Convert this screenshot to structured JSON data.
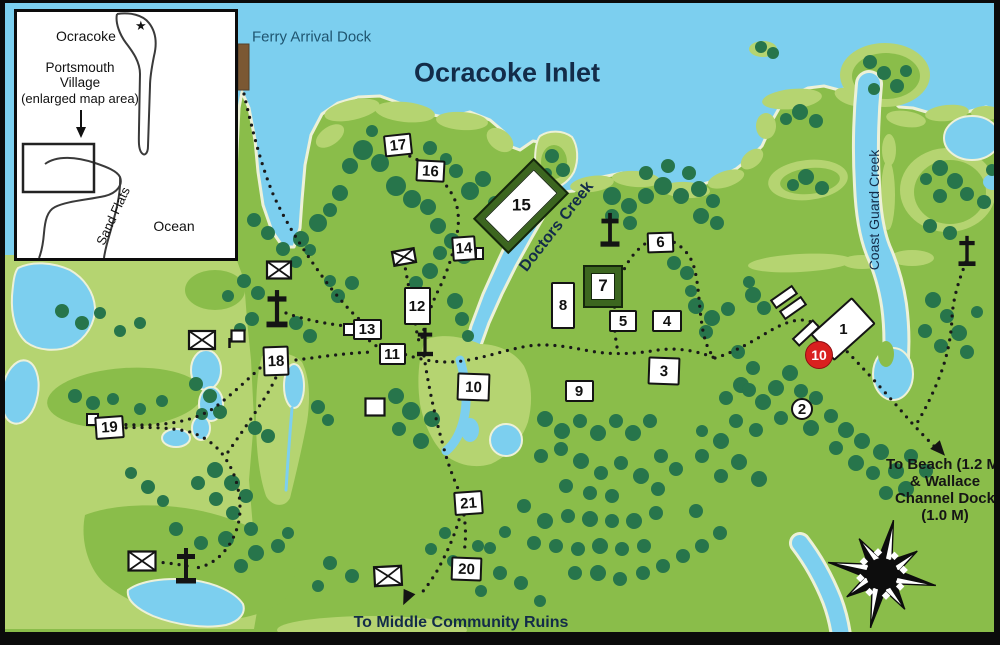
{
  "colors": {
    "water": "#7ccfef",
    "land": "#8abd4a",
    "land_light": "#b5d471",
    "trees": "#27754b",
    "shore": "#edf1d8",
    "trail": "#191919",
    "marker_red": "#d9201f",
    "navy": "#132c49",
    "ferry_label": "#1f5570",
    "dock_brown": "#7b5833"
  },
  "labels": [
    {
      "id": "ferry-arrival-dock",
      "text": "Ferry Arrival Dock",
      "x": 247,
      "y": 34,
      "size": 15,
      "color": "#1f5570",
      "rot": 0,
      "anchor": "left",
      "weight": "normal"
    },
    {
      "id": "ocracoke-inlet",
      "text": "Ocracoke Inlet",
      "x": 502,
      "y": 70,
      "size": 27,
      "color": "#132c49",
      "rot": 0,
      "anchor": "center",
      "weight": "600"
    },
    {
      "id": "doctors-creek",
      "text": "Doctors Creek",
      "x": 552,
      "y": 224,
      "size": 16,
      "color": "#132c49",
      "rot": -52,
      "anchor": "center",
      "weight": "bold"
    },
    {
      "id": "coast-guard-creek",
      "text": "Coast Guard Creek",
      "x": 869,
      "y": 207,
      "size": 14,
      "color": "#132c49",
      "rot": -90,
      "anchor": "center",
      "weight": "normal"
    },
    {
      "id": "to-middle-community-ruins",
      "text": "To Middle Community Ruins",
      "x": 456,
      "y": 620,
      "size": 16,
      "color": "#132c49",
      "rot": 0,
      "anchor": "center",
      "weight": "bold"
    },
    {
      "id": "to-beach-wallace-dock",
      "lines": [
        "To Beach (1.2 M)",
        "& Wallace",
        "Channel Dock",
        "(1.0 M)"
      ],
      "x": 940,
      "y": 487,
      "size": 15,
      "color": "#151515",
      "rot": 0,
      "anchor": "center",
      "weight": "bold"
    }
  ],
  "inset": {
    "region": "Ocracoke",
    "star": "★",
    "village_line1": "Portsmouth",
    "village_line2": "Village",
    "village_line3": "(enlarged map area)",
    "sand_flats": "Sand Flats",
    "ocean": "Ocean"
  },
  "markers": [
    {
      "num": "1",
      "x": 838,
      "y": 326,
      "w": 56,
      "h": 36,
      "rot": -42,
      "type": "building"
    },
    {
      "num": "2",
      "x": 797,
      "y": 406,
      "r": 11,
      "type": "circle"
    },
    {
      "num": "3",
      "x": 659,
      "y": 368,
      "w": 32,
      "h": 28,
      "rot": 2,
      "type": "box"
    },
    {
      "num": "4",
      "x": 662,
      "y": 318,
      "w": 30,
      "h": 22,
      "rot": 0,
      "type": "box"
    },
    {
      "num": "5",
      "x": 618,
      "y": 318,
      "w": 28,
      "h": 22,
      "rot": 0,
      "type": "box"
    },
    {
      "num": "6",
      "x": 655,
      "y": 239,
      "w": 27,
      "h": 21,
      "rot": -2,
      "type": "box"
    },
    {
      "num": "7",
      "x": 598,
      "y": 283,
      "w": 40,
      "h": 43,
      "rot": 0,
      "type": "box-green"
    },
    {
      "num": "8",
      "x": 558,
      "y": 302,
      "w": 24,
      "h": 47,
      "rot": 0,
      "type": "box"
    },
    {
      "num": "9",
      "x": 574,
      "y": 388,
      "w": 29,
      "h": 22,
      "rot": 0,
      "type": "box"
    },
    {
      "num": "10",
      "x": 814,
      "y": 352,
      "r": 14,
      "type": "circle-red",
      "highlight": true
    },
    {
      "num": "10",
      "x": 468,
      "y": 384,
      "w": 33,
      "h": 28,
      "rot": 2,
      "type": "box"
    },
    {
      "num": "11",
      "x": 387,
      "y": 351,
      "w": 27,
      "h": 22,
      "rot": 0,
      "type": "box"
    },
    {
      "num": "12",
      "x": 412,
      "y": 303,
      "w": 27,
      "h": 38,
      "rot": 0,
      "type": "box"
    },
    {
      "num": "13",
      "x": 362,
      "y": 326,
      "w": 29,
      "h": 21,
      "rot": 0,
      "type": "box",
      "attach": {
        "x": 344,
        "y": 326,
        "w": 13,
        "h": 13
      }
    },
    {
      "num": "14",
      "x": 459,
      "y": 245,
      "w": 24,
      "h": 25,
      "rot": -4,
      "type": "box",
      "attach": {
        "x": 474,
        "y": 250,
        "w": 9,
        "h": 13
      }
    },
    {
      "num": "15",
      "x": 516,
      "y": 203,
      "w": 86,
      "h": 50,
      "rot": -45,
      "type": "building-green"
    },
    {
      "num": "16",
      "x": 425,
      "y": 168,
      "w": 29,
      "h": 22,
      "rot": 3,
      "type": "box"
    },
    {
      "num": "17",
      "x": 393,
      "y": 142,
      "w": 28,
      "h": 22,
      "rot": -6,
      "type": "box"
    },
    {
      "num": "18",
      "x": 271,
      "y": 358,
      "w": 26,
      "h": 30,
      "rot": -2,
      "type": "box"
    },
    {
      "num": "19",
      "x": 104,
      "y": 424,
      "w": 29,
      "h": 23,
      "rot": -4,
      "type": "box",
      "attach": {
        "x": 87,
        "y": 416,
        "w": 13,
        "h": 13
      }
    },
    {
      "num": "20",
      "x": 461,
      "y": 566,
      "w": 31,
      "h": 24,
      "rot": 2,
      "type": "box"
    },
    {
      "num": "21",
      "x": 463,
      "y": 500,
      "w": 29,
      "h": 24,
      "rot": -4,
      "type": "box"
    }
  ],
  "icons": {
    "crosses": [
      {
        "x": 277,
        "y": 310,
        "s": 1.05
      },
      {
        "x": 425,
        "y": 343,
        "s": 0.8
      },
      {
        "x": 610,
        "y": 231,
        "s": 0.95
      },
      {
        "x": 186,
        "y": 567,
        "s": 1.0
      },
      {
        "x": 967,
        "y": 252,
        "s": 0.85
      }
    ],
    "cemeteries": [
      {
        "x": 279,
        "y": 270,
        "w": 24,
        "h": 17,
        "rot": 0
      },
      {
        "x": 202,
        "y": 340,
        "w": 26,
        "h": 18,
        "rot": 0
      },
      {
        "x": 404,
        "y": 257,
        "w": 22,
        "h": 14,
        "rot": -10
      },
      {
        "x": 142,
        "y": 561,
        "w": 27,
        "h": 19,
        "rot": 0
      },
      {
        "x": 388,
        "y": 576,
        "w": 27,
        "h": 19,
        "rot": -3
      }
    ],
    "small_boxes": [
      {
        "x": 375,
        "y": 407,
        "w": 19,
        "h": 17
      },
      {
        "x": 238,
        "y": 336,
        "w": 13,
        "h": 11,
        "flag": true
      }
    ],
    "bars": [
      {
        "x": 784,
        "y": 297,
        "w": 25,
        "h": 9,
        "rot": -35
      },
      {
        "x": 793,
        "y": 308,
        "w": 25,
        "h": 9,
        "rot": -35
      },
      {
        "x": 806,
        "y": 333,
        "w": 27,
        "h": 9,
        "rot": -43
      }
    ],
    "arrows": [
      {
        "x": 939,
        "y": 449,
        "rot": -42,
        "dest": "beach"
      },
      {
        "x": 407,
        "y": 597,
        "rot": 25,
        "dest": "ruins"
      }
    ],
    "dock": {
      "x": 238,
      "y": 44,
      "w": 11,
      "h": 46
    }
  },
  "compass": {
    "x": 882,
    "y": 574,
    "r": 55
  }
}
